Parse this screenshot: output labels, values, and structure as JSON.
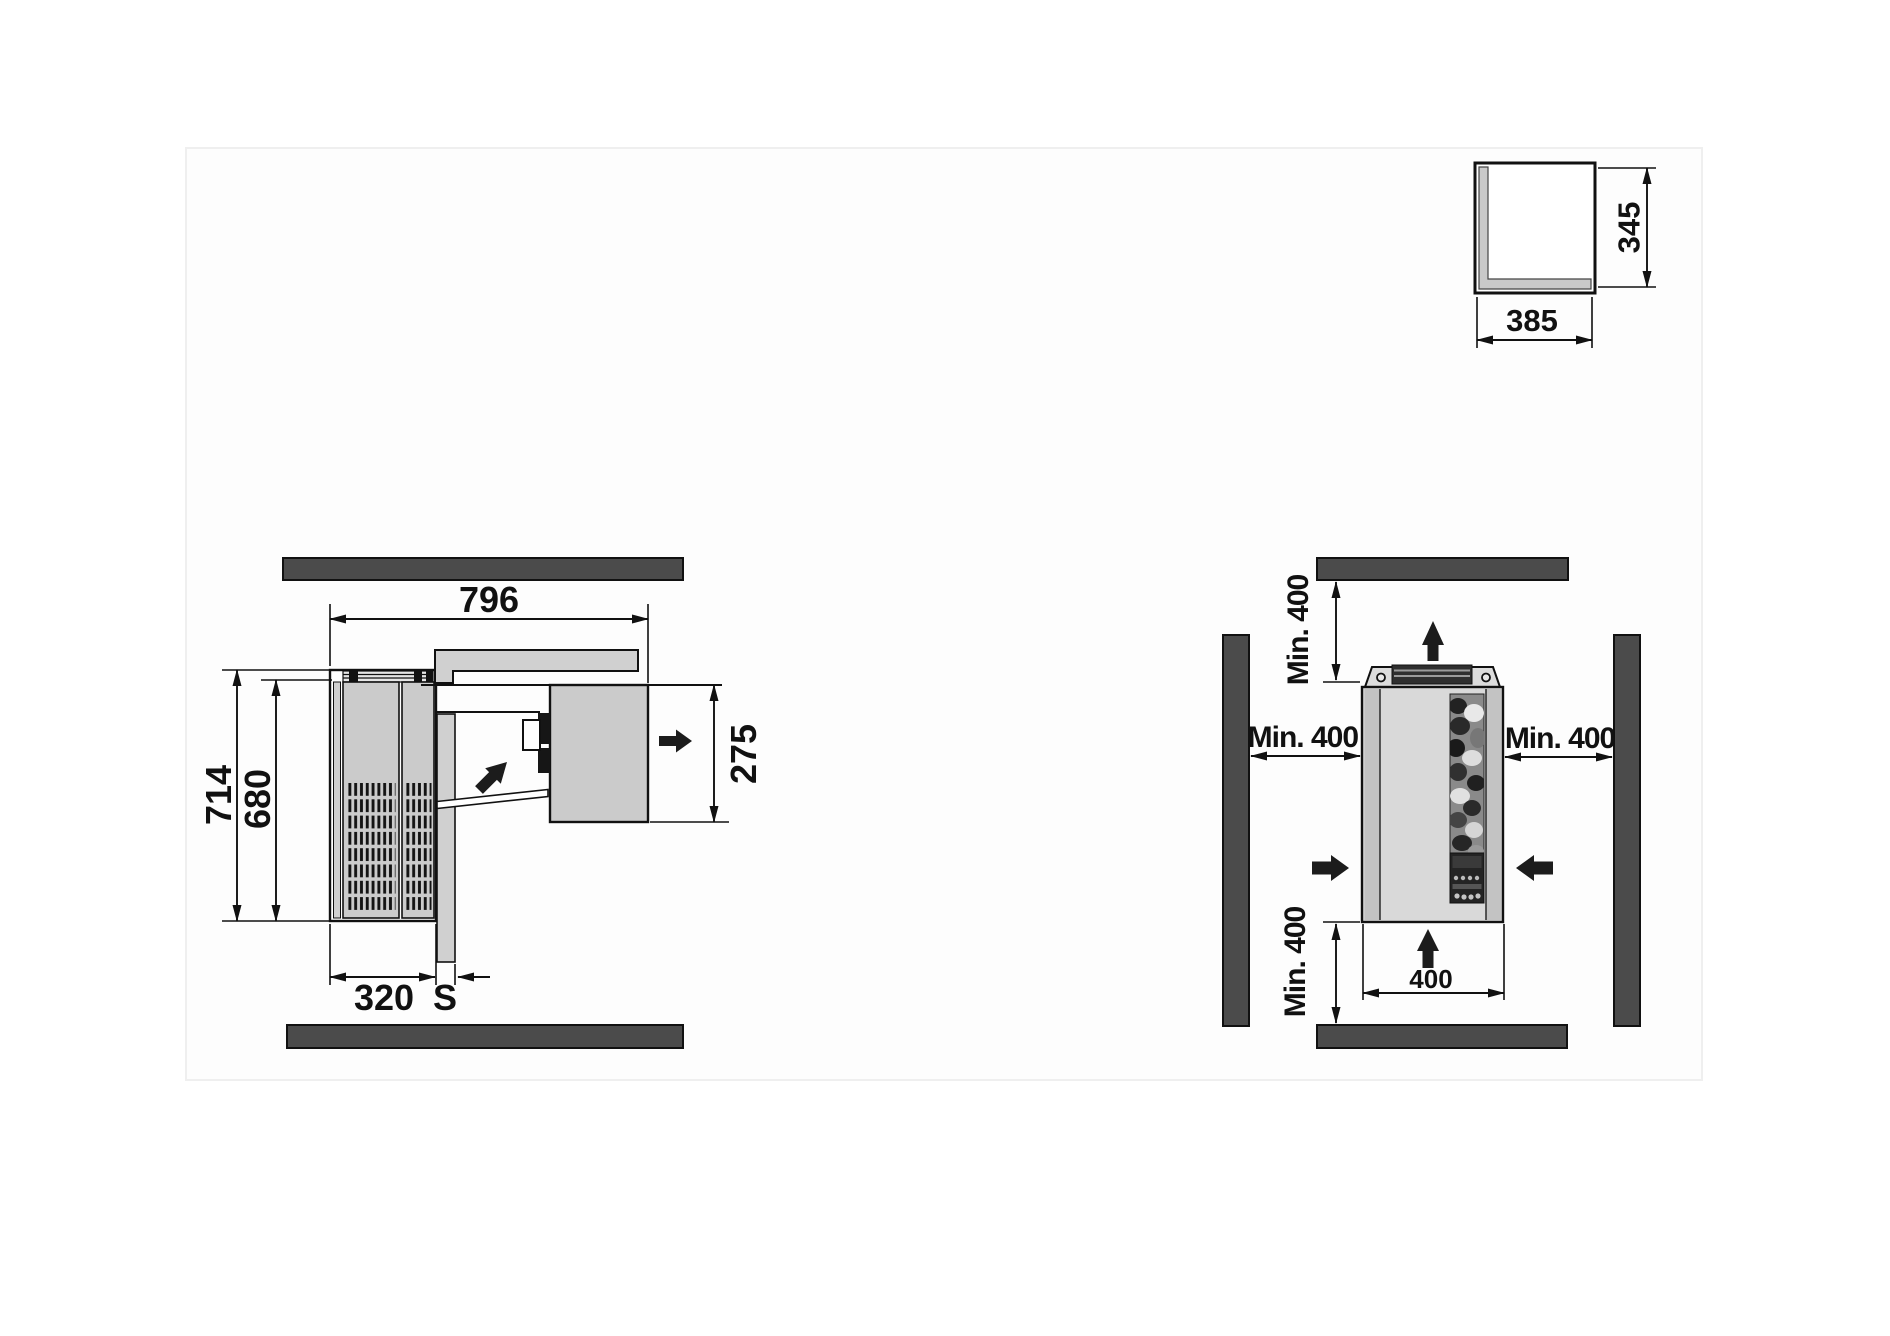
{
  "colors": {
    "wall": "#4b4b4b",
    "outline": "#111111",
    "panel": "#cbcbcb",
    "panel_light": "#d9d9d9",
    "housing": "#d0d0d0",
    "arrow": "#1c1c1c"
  },
  "corner_view": {
    "width": "385",
    "height": "345"
  },
  "plan_view": {
    "depth_total": "796",
    "width_total": "714",
    "width_body": "680",
    "depth_outdoor": "320",
    "wall_thickness": "S",
    "depth_indoor": "275"
  },
  "front_view": {
    "clearance_top": "Min. 400",
    "clearance_left": "Min. 400",
    "clearance_right": "Min. 400",
    "clearance_bottom": "Min. 400",
    "unit_width": "400"
  }
}
